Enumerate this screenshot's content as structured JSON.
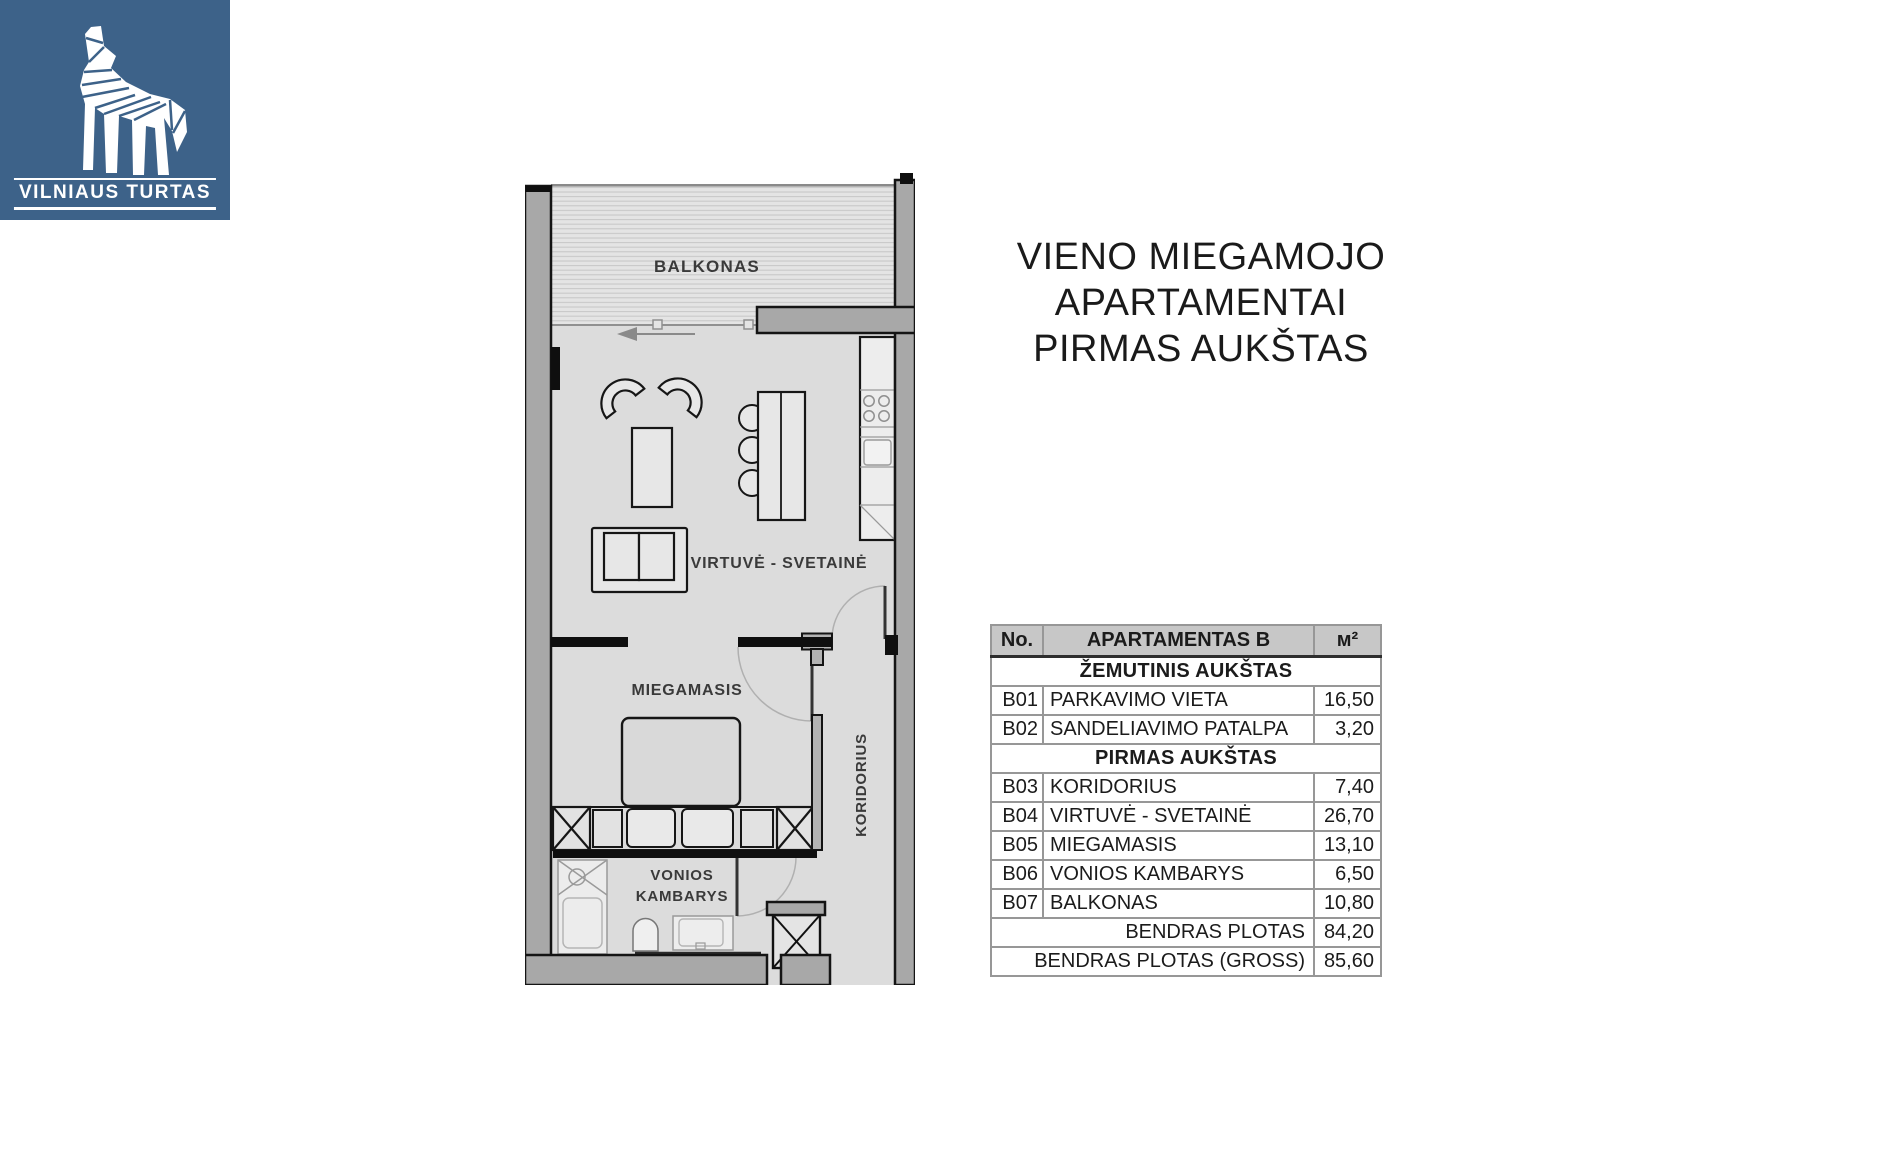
{
  "logo": {
    "brand": "VILNIAUS TURTAS",
    "background_color": "#3d6289",
    "wolf_icon": "geometric-howling-wolf"
  },
  "title": {
    "lines": [
      "VIENO MIEGAMOJO",
      "APARTAMENTAI",
      "PIRMAS AUKŠTAS"
    ]
  },
  "floorplan": {
    "rooms": {
      "balcony": "BALKONAS",
      "kitchen_living": "VIRTUVĖ - SVETAINĖ",
      "bedroom": "MIEGAMASIS",
      "bathroom_line1": "VONIOS",
      "bathroom_line2": "KAMBARYS",
      "corridor": "KORIDORIUS"
    }
  },
  "table": {
    "headers": [
      "No.",
      "APARTAMENTAS B",
      "м²"
    ],
    "groups": [
      {
        "section": "ŽEMUTINIS AUKŠTAS",
        "rows": [
          {
            "no": "B01",
            "name": "PARKAVIMO VIETA",
            "area": "16,50"
          },
          {
            "no": "B02",
            "name": "SANDELIAVIMO PATALPA",
            "area": "3,20"
          }
        ]
      },
      {
        "section": "PIRMAS AUKŠTAS",
        "rows": [
          {
            "no": "B03",
            "name": "KORIDORIUS",
            "area": "7,40"
          },
          {
            "no": "B04",
            "name": "VIRTUVĖ - SVETAINĖ",
            "area": "26,70"
          },
          {
            "no": "B05",
            "name": "MIEGAMASIS",
            "area": "13,10"
          },
          {
            "no": "B06",
            "name": "VONIOS KAMBARYS",
            "area": "6,50"
          },
          {
            "no": "B07",
            "name": "BALKONAS",
            "area": "10,80"
          }
        ]
      }
    ],
    "totals": [
      {
        "label": "BENDRAS PLOTAS",
        "value": "84,20"
      },
      {
        "label": "BENDRAS PLOTAS  (GROSS)",
        "value": "85,60"
      }
    ]
  }
}
